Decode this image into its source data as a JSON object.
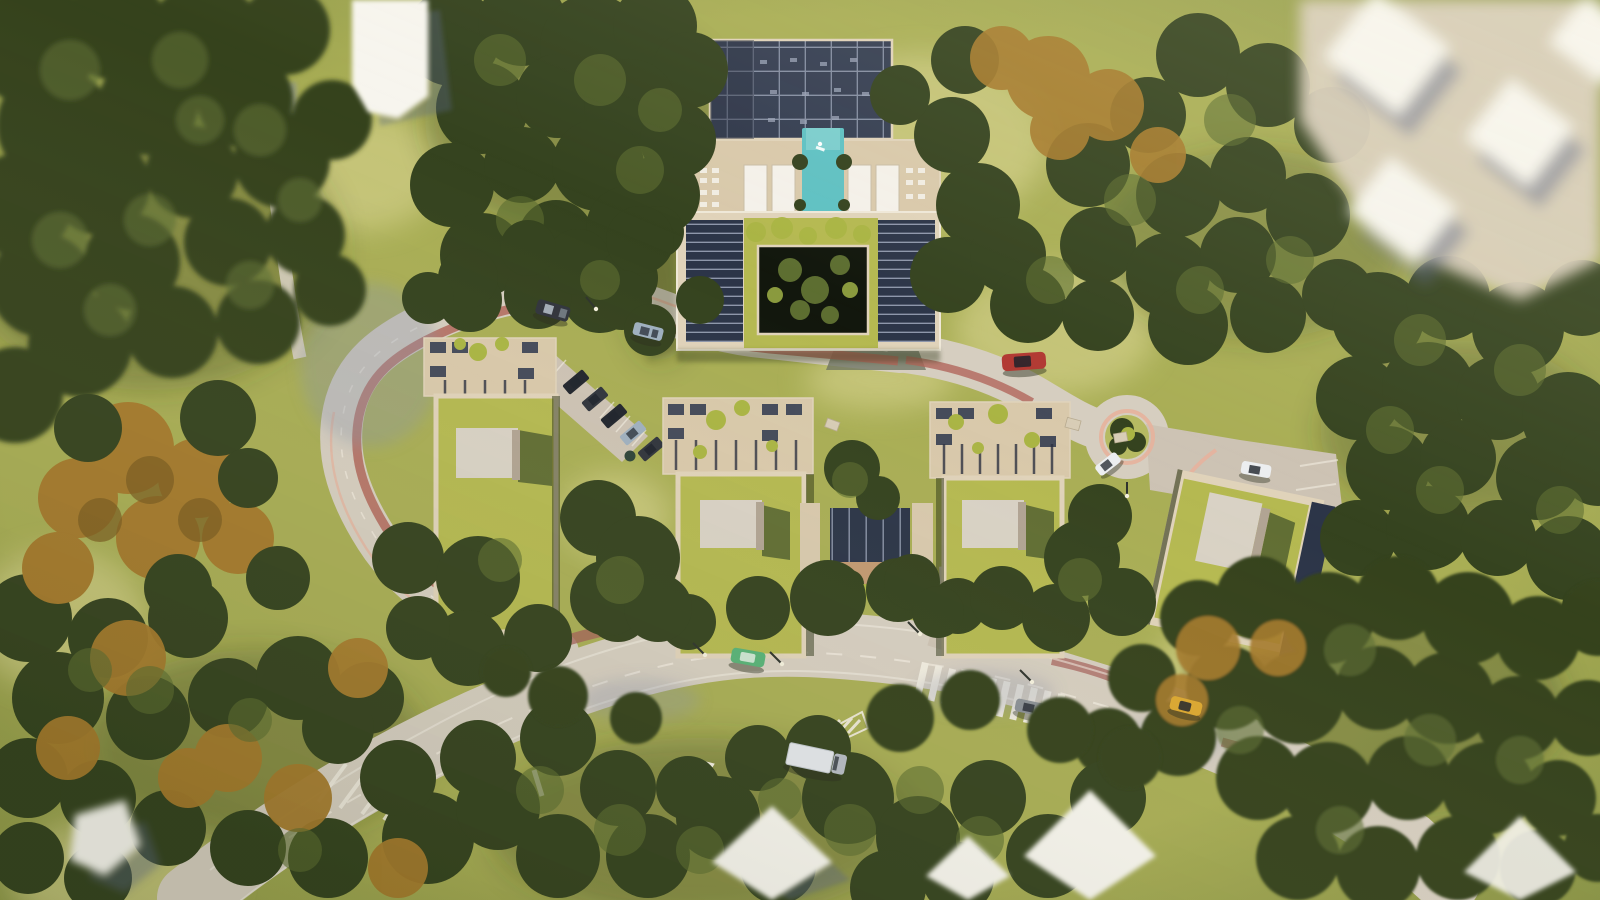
{
  "scene": {
    "kind": "aerial-architectural-render",
    "setting": "top-down bird's-eye 3D rendering of a residential complex in a forested site, daylight",
    "landmarks": {
      "main_building": "u-shaped-apartment-block-with-green-roof-courtyard",
      "amenity_deck": "rooftop-pool-deck-with-pergola-lounge",
      "pool": "turquoise-rooftop-pool",
      "residential_blocks": [
        "west-green-roof-block",
        "center-green-roof-block",
        "east-green-roof-block",
        "southeast-rotated-green-roof-block"
      ],
      "roundabout": "landscaped-traffic-circle",
      "roads": [
        "inner-loop-road-with-red-bike-lane",
        "main-road-with-crosswalks",
        "northwest-service-path",
        "southeast-driveway"
      ],
      "parking": "angled-parking-bay-with-five-cars",
      "crosswalks": "white-zebra-stripes-and-hatched-islands",
      "surroundings": "blurred-white-neighbour-houses-at-image-corners"
    },
    "vehicles": [
      {
        "name": "car-dark-gray",
        "road": "upper-loop"
      },
      {
        "name": "car-silver-blue",
        "road": "upper-loop"
      },
      {
        "name": "car-red",
        "road": "east-loop"
      },
      {
        "name": "car-white-roundabout",
        "road": "roundabout-exit"
      },
      {
        "name": "car-white-driveway",
        "road": "southeast-driveway"
      },
      {
        "name": "car-green",
        "road": "main-road-west"
      },
      {
        "name": "car-gray",
        "road": "main-road-junction"
      },
      {
        "name": "car-yellow",
        "road": "main-road-east"
      },
      {
        "name": "truck-white",
        "road": "main-road-south"
      },
      {
        "name": "parked-cars-x5",
        "road": "parking-bay"
      }
    ]
  },
  "colors": {
    "grass_base": "#7e8a40",
    "grass_mid": "#a9ae55",
    "grass_light": "#b6ba62",
    "sun_patch": "#dcd794",
    "ground_shadow": "#343e1f",
    "tree_dark": "#35431f",
    "tree_mid": "#5d6e31",
    "tree_light": "#8a9a3e",
    "tree_bright": "#aab544",
    "tree_autumn": "#a67b2d",
    "tree_autumn_dark": "#7c5c20",
    "road": "#d6cec0",
    "road_warm": "#cdc3b4",
    "road_shadow": "#8d94a8",
    "marking": "#f2ede1",
    "bike_lane": "#b2675b",
    "curb_pink": "#e7b29c",
    "sidewalk_red": "#a4605a",
    "deck_tan": "#d9c9ab",
    "frame_beige": "#e0d3ba",
    "roof_green": "#b5b951",
    "roof_green_dark": "#8f9a43",
    "cube": "#d9d2c5",
    "cube_side": "#b1a493",
    "cube_shadow": "#586631",
    "panel_navy": "#2c3548",
    "panel_line": "#99a2b6",
    "pergola_navy": "#353e52",
    "pergola_dark": "#2a3143",
    "courtyard_dark": "#12170d",
    "pool": "#5fc1c3",
    "pool_light": "#8ad6d4",
    "white_roof": "#f7f5ee",
    "white_shadow": "#5c6788",
    "cabana": "#f4f1ea",
    "post_beige": "#d8c9ad",
    "canopy_ground": "#c29a72",
    "rock": "#d8cdb6",
    "bin": "#2e4438",
    "lamp_pole": "#2e332c",
    "lamp_head": "#f4f0dd",
    "cars": {
      "dark": "#31353d",
      "dark2": "#22262e",
      "silver": "#a9b3bd",
      "silver_blue": "#9fb0bf",
      "red": "#b23a33",
      "green": "#58b277",
      "green_roof": "#d2e8d8",
      "yellow": "#dca830",
      "white": "#eceef0",
      "gray": "#8b9096",
      "truck": "#e4e7eb",
      "truck_cab": "#b6bcc4",
      "window": "#1e232c",
      "shadow": "#2a2f1d"
    }
  }
}
